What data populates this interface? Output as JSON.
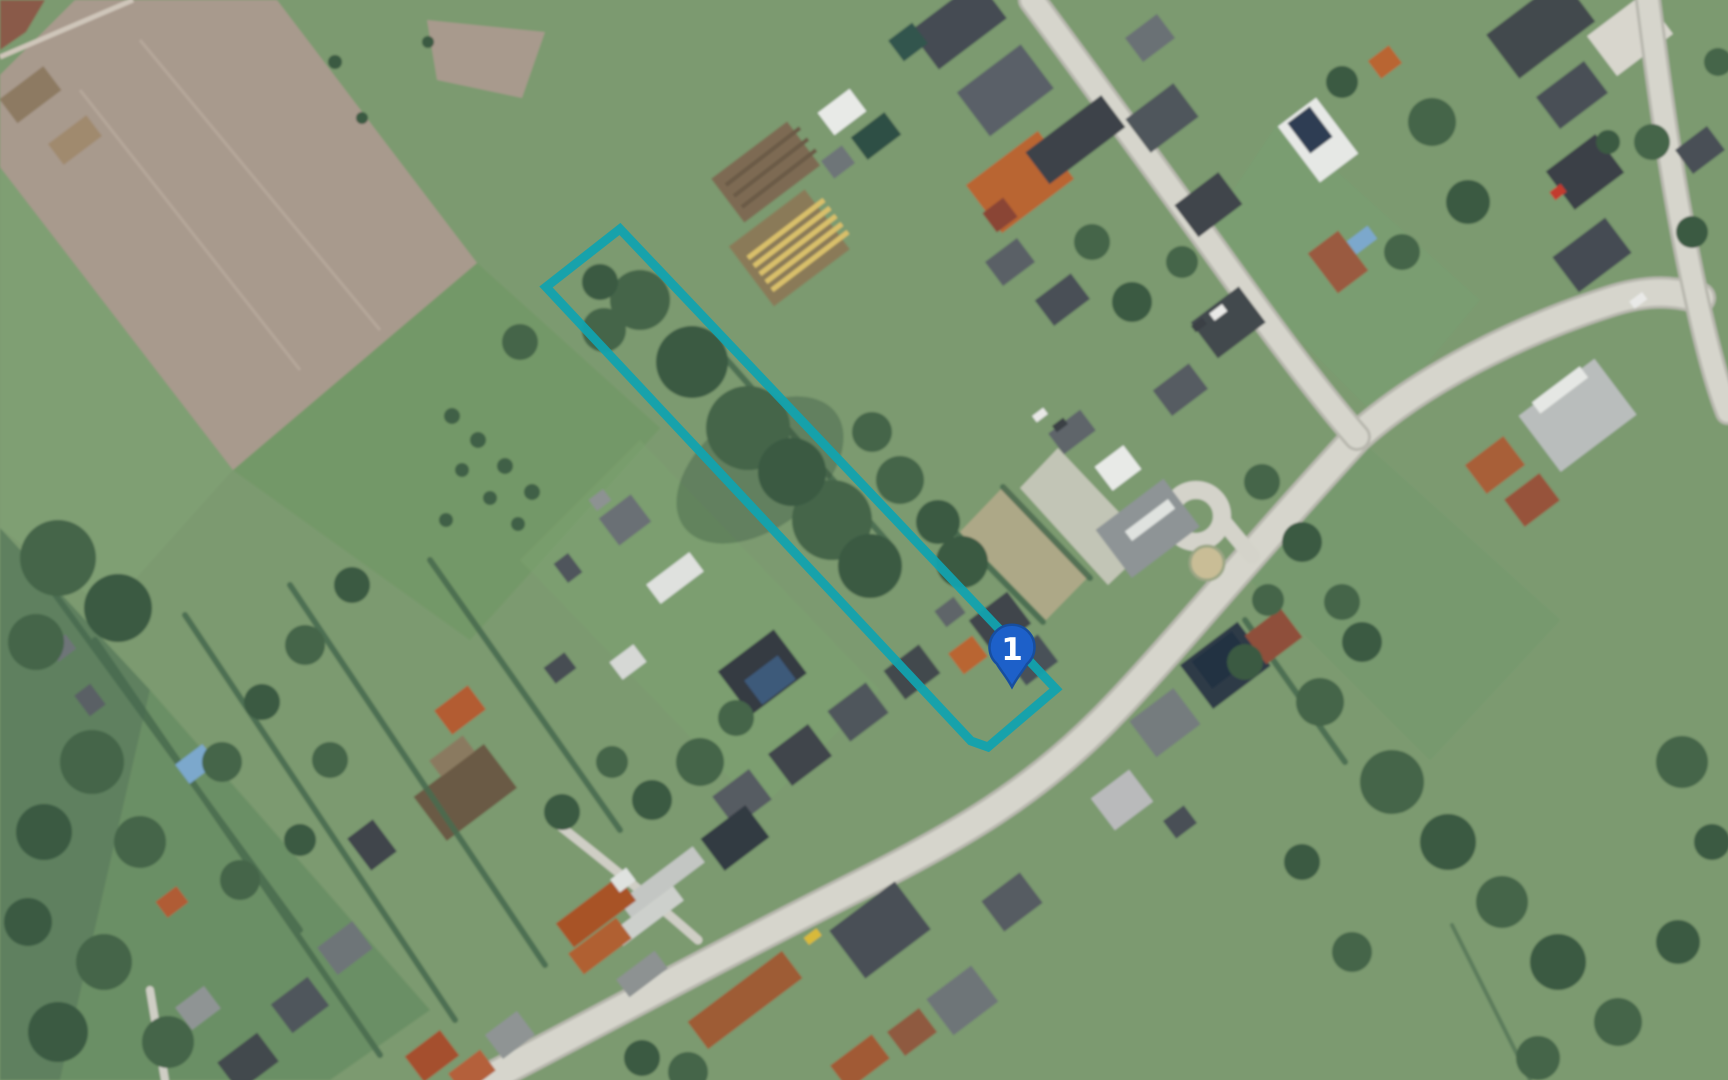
{
  "map": {
    "view_type": "aerial-satellite-imagery",
    "marker": {
      "label": "1",
      "tip_x": 1012,
      "tip_y": 687,
      "fill": "#1d60c9",
      "border": "#174e9f",
      "label_color": "#ffffff"
    },
    "parcel_outline": {
      "stroke": "#12a2ae",
      "stroke_width": 9,
      "opacity": 0.95,
      "fill": "none",
      "vertices": [
        [
          620,
          229
        ],
        [
          1056,
          689
        ],
        [
          988,
          747
        ],
        [
          971,
          741
        ],
        [
          546,
          287
        ]
      ]
    },
    "palette": {
      "grass": "#7b9a70",
      "field_tan": "#a89a8d",
      "field_dark_red": "#8a5a49",
      "road": "#d6d5cc",
      "road_casing": "#b8b7ae",
      "tree_green": "#456549",
      "tree_dark": "#3b5a42",
      "hedge": "#4a6b50",
      "roof_dark": "#42484e",
      "roof_orange": "#b96531",
      "roof_red": "#a85328",
      "roof_light": "#c9ccc9",
      "khaki_lawn": "#b3aa8a",
      "pool_blue": "#7ca8cc"
    }
  }
}
